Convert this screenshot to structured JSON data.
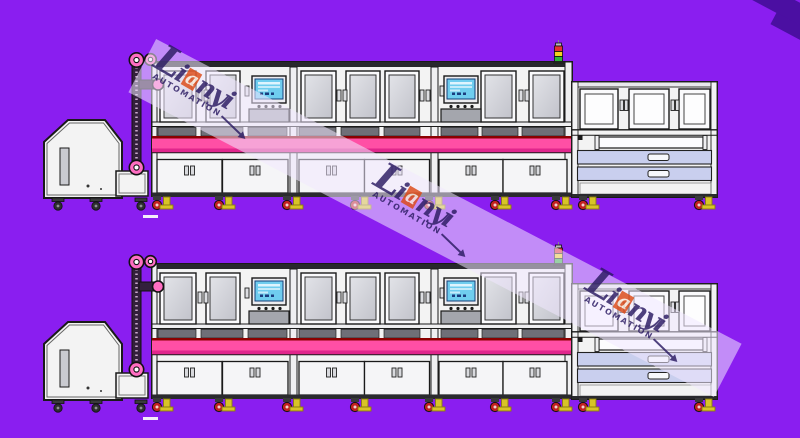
{
  "background_color": "#8A1EF0",
  "watermark": {
    "brand_l": "L",
    "brand_i": "i",
    "brand_a": "a",
    "brand_rest": "nyi",
    "subtitle": "AUTOMATION",
    "band_color": "rgba(240,231,255,0.55)",
    "text_color": "#2A1A62",
    "accent_color": "#DD4A16",
    "corner_color": "#4B0FA2"
  },
  "drawing": {
    "colors": {
      "machine_body": "#F3F3F3",
      "outline": "#1A1A1A",
      "window_glass": "#D4D5DA",
      "conveyor_pink": "#FF4FA5",
      "conveyor_dark_pink": "#E0268C",
      "conveyor_top_line": "#8B0000",
      "vent_gray": "#6F6F77",
      "drawer_lavender": "#C9CFEE",
      "screen_blue": "#6FCDEF",
      "pulley_pink": "#FF6EC2",
      "caster_red": "#C42020",
      "foot_yellow": "#D8C427",
      "tower_red": "#E53030",
      "tower_yellow": "#F2D21F",
      "tower_green": "#2FB53A"
    }
  }
}
